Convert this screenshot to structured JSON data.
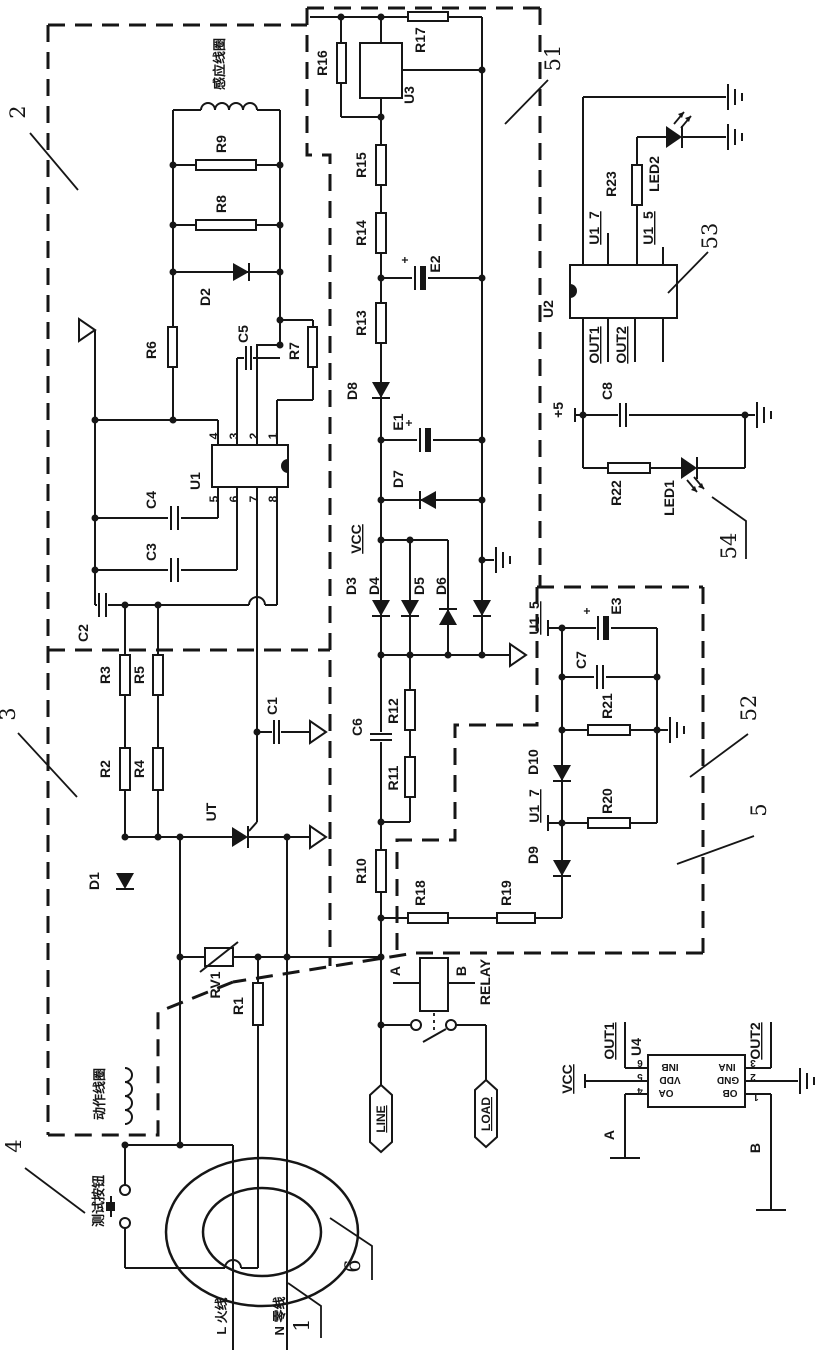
{
  "colors": {
    "ink": "#161616",
    "background": "#ffffff"
  },
  "callouts": {
    "n1": "1",
    "n2": "2",
    "n3": "3",
    "n4": "4",
    "n5": "5",
    "n6": "6",
    "n51": "51",
    "n52": "52",
    "n53": "53",
    "n54": "54"
  },
  "texts": {
    "induction_coil": "感应线圈",
    "action_coil": "动作线圈",
    "test_button": "测试按钮",
    "live_wire": "L 火线",
    "neutral_wire": "N 零线",
    "r1": "R1",
    "r2": "R2",
    "r3": "R3",
    "r4": "R4",
    "r5": "R5",
    "r6": "R6",
    "r7": "R7",
    "r8": "R8",
    "r9": "R9",
    "r10": "R10",
    "r11": "R11",
    "r12": "R12",
    "r13": "R13",
    "r14": "R14",
    "r15": "R15",
    "r16": "R16",
    "r17": "R17",
    "r18": "R18",
    "r19": "R19",
    "r20": "R20",
    "r21": "R21",
    "r22": "R22",
    "r23": "R23",
    "rv1": "RV1",
    "c1": "C1",
    "c2": "C2",
    "c3": "C3",
    "c4": "C4",
    "c5": "C5",
    "c6": "C6",
    "c7": "C7",
    "c8": "C8",
    "e1": "E1",
    "e2": "E2",
    "e3": "E3",
    "d1": "D1",
    "d2": "D2",
    "d3": "D3",
    "d4": "D4",
    "d5": "D5",
    "d6": "D6",
    "d7": "D7",
    "d8": "D8",
    "d9": "D9",
    "d10": "D10",
    "led1": "LED1",
    "led2": "LED2",
    "u1": "U1",
    "u2": "U2",
    "u3": "U3",
    "u4": "U4",
    "ut": "UT",
    "vcc": "VCC",
    "plus5": "+5",
    "plus": "+",
    "net_u1_5": "U1_5",
    "net_u1_7": "U1_7",
    "out1": "OUT1",
    "out2": "OUT2",
    "relay": "RELAY",
    "pin_a": "A",
    "pin_b": "B",
    "line": "LINE",
    "load": "LOAD",
    "inb": "INB",
    "vdd": "VDD",
    "oa": "OA",
    "ina": "INA",
    "gnd": "GND",
    "ob": "OB",
    "pin1": "1",
    "pin2": "2",
    "pin3": "3",
    "pin4": "4",
    "pin5": "5",
    "pin6": "6",
    "pin7": "7",
    "pin8": "8"
  }
}
